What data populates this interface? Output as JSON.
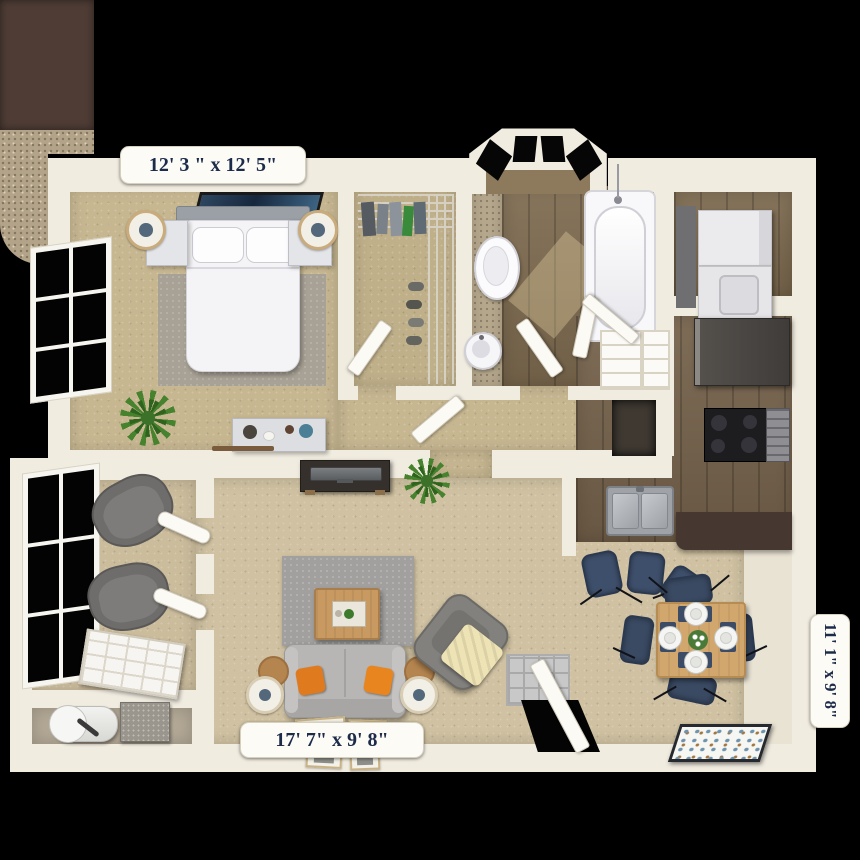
{
  "floorplan": {
    "bedroom_label": "12' 3 \" x 12' 5\"",
    "living_label": "17' 7\" x 9' 8\"",
    "dining_label": "11' 1\" x 9' 8\"",
    "rooms": [
      {
        "name": "bedroom",
        "furniture": [
          "bed",
          "headboard",
          "pillows",
          "nightstand-left",
          "nightstand-right",
          "table-lamps",
          "wall-art",
          "area-rug",
          "dresser",
          "potted-plant",
          "window"
        ]
      },
      {
        "name": "walk-in-closet",
        "furniture": [
          "wire-shelving",
          "hanging-clothes",
          "shoes",
          "door"
        ]
      },
      {
        "name": "bathroom",
        "furniture": [
          "bay-window",
          "toilet",
          "pedestal-sink",
          "bathtub",
          "linen-shelves",
          "doors"
        ]
      },
      {
        "name": "laundry-closet",
        "furniture": [
          "stacked-washer",
          "stacked-dryer"
        ]
      },
      {
        "name": "kitchen",
        "furniture": [
          "refrigerator",
          "range-stove",
          "oven",
          "granite-counters",
          "double-sink",
          "breakfast-bar",
          "bar-stools"
        ]
      },
      {
        "name": "dining-area",
        "furniture": [
          "dining-table",
          "dining-chairs",
          "place-settings",
          "centerpiece",
          "wall-art"
        ]
      },
      {
        "name": "living-room",
        "furniture": [
          "sofa",
          "orange-throw-pillows",
          "coffee-table",
          "area-rug",
          "armchair",
          "throw-blanket",
          "side-tables",
          "lamps",
          "tv-console",
          "tv",
          "plant",
          "picture-frames",
          "entry-door",
          "entry-mat"
        ]
      },
      {
        "name": "patio",
        "furniture": [
          "lounge-chairs",
          "sliding-door",
          "windows",
          "french-doors"
        ]
      },
      {
        "name": "utility-closet",
        "furniture": [
          "water-heater",
          "hvac-unit"
        ]
      }
    ],
    "colors": {
      "background": "#000000",
      "wall": "#f1ece0",
      "bedroom_carpet": "#c7b791",
      "living_carpet": "#cfc1a1",
      "wood_floor": "#7d6a4f",
      "cabinet_brown": "#4e3c35",
      "granite_counter": "#b2a389",
      "rug_gray": "#a0a0a0",
      "sofa_gray": "#b7b6b4",
      "accent_orange": "#e07a1f",
      "navy_furniture": "#3a4a63",
      "label_text": "#1d2b4a",
      "label_background": "#fcfbf5"
    }
  }
}
